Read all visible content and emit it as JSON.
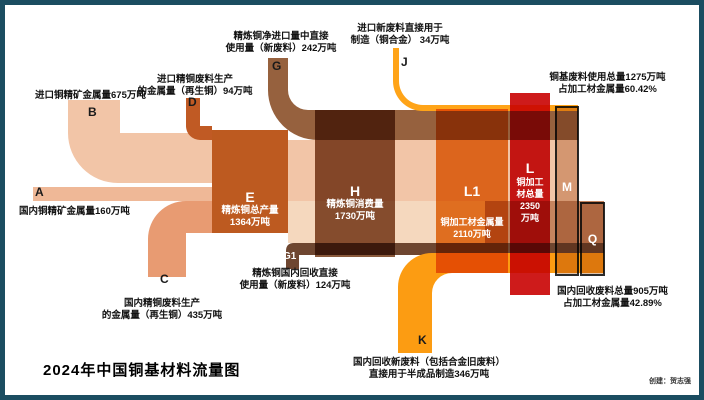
{
  "title": "2024年中国铜基材料流量图",
  "credit": "创建：贺志强",
  "unit": "万吨",
  "colors": {
    "frame": "#1B4D61",
    "peach": "#F2C5A7",
    "salmon": "#E89B72",
    "rust": "#C05A24",
    "e_node": "#BD5A20",
    "brown": "#96613E",
    "h_node": "#8A5A3C",
    "dark_brown": "#6E4630",
    "k_orange": "#FC9C12",
    "j_orange": "#FFA418",
    "l1_node": "#E8822B",
    "l_node": "#CE1B1B",
    "cream": "#F5D8BE",
    "tan": "#C5845E",
    "box_border": "#2A2A2A"
  },
  "flows": {
    "a": {
      "letter": "A",
      "label": "国内铜精矿金属量160万吨",
      "value": 160
    },
    "b": {
      "letter": "B",
      "label": "进口铜精矿金属量675万吨",
      "value": 675
    },
    "c": {
      "letter": "C",
      "label_line1": "国内精铜废料生产",
      "label_line2": "的金属量（再生铜）435万吨",
      "value": 435
    },
    "d": {
      "letter": "D",
      "label_line1": "进口精铜废料生产",
      "label_line2": "的金属量（再生铜）94万吨",
      "value": 94
    },
    "g": {
      "letter": "G",
      "label_line1": "精炼铜净进口量中直接",
      "label_line2": "使用量（新废料）242万吨",
      "value": 242
    },
    "g1": {
      "letter": "G1",
      "label_line1": "精炼铜国内回收直接",
      "label_line2": "使用量（新废料）124万吨",
      "value": 124
    },
    "j": {
      "letter": "J",
      "label_line1": "进口新废料直接用于",
      "label_line2": "制造（铜合金） 34万吨",
      "value": 34
    },
    "k": {
      "letter": "K",
      "label_line1": "国内回收新废料（包括合金旧废料）",
      "label_line2": "直接用于半成品制造346万吨",
      "value": 346
    }
  },
  "nodes": {
    "e": {
      "letter": "E",
      "name": "精炼铜总产量",
      "value_text": "1364万吨",
      "value": 1364
    },
    "h": {
      "letter": "H",
      "name": "精炼铜消费量",
      "value_text": "1730万吨",
      "value": 1730
    },
    "l1": {
      "letter": "L1",
      "name": "铜加工材金属量",
      "value_text": "2110万吨",
      "value": 2110
    },
    "l": {
      "letter": "L",
      "name_line1": "铜加工",
      "name_line2": "材总量",
      "value_line1": "2350",
      "value_line2": "万吨",
      "value": 2350
    },
    "m": {
      "letter": "M",
      "label_line1": "铜基废料使用总量1275万吨",
      "label_line2": "占加工材金属量60.42%",
      "value": 1275
    },
    "q": {
      "letter": "Q",
      "label_line1": "国内回收废料总量905万吨",
      "label_line2": "占加工材金属量42.89%",
      "value": 905
    }
  },
  "chart_data": {
    "type": "sankey",
    "title": "2024年中国铜基材料流量图",
    "unit": "万吨",
    "nodes": [
      {
        "id": "A",
        "label": "国内铜精矿金属量",
        "value": 160
      },
      {
        "id": "B",
        "label": "进口铜精矿金属量",
        "value": 675
      },
      {
        "id": "C",
        "label": "国内精铜废料生产的金属量（再生铜）",
        "value": 435
      },
      {
        "id": "D",
        "label": "进口精铜废料生产的金属量（再生铜）",
        "value": 94
      },
      {
        "id": "E",
        "label": "精炼铜总产量",
        "value": 1364
      },
      {
        "id": "G",
        "label": "精炼铜净进口量中直接使用量（新废料）",
        "value": 242
      },
      {
        "id": "G1",
        "label": "精炼铜国内回收直接使用量（新废料）",
        "value": 124
      },
      {
        "id": "H",
        "label": "精炼铜消费量",
        "value": 1730
      },
      {
        "id": "J",
        "label": "进口新废料直接用于制造（铜合金）",
        "value": 34
      },
      {
        "id": "K",
        "label": "国内回收新废料（包括合金旧废料）直接用于半成品制造",
        "value": 346
      },
      {
        "id": "L1",
        "label": "铜加工材金属量",
        "value": 2110
      },
      {
        "id": "L",
        "label": "铜加工材总量",
        "value": 2350
      }
    ],
    "links": [
      {
        "source": "A",
        "target": "E",
        "value": 160
      },
      {
        "source": "B",
        "target": "E",
        "value": 675
      },
      {
        "source": "C",
        "target": "E",
        "value": 435
      },
      {
        "source": "D",
        "target": "E",
        "value": 94
      },
      {
        "source": "E",
        "target": "H",
        "value": 1364
      },
      {
        "source": "G",
        "target": "H",
        "value": 242
      },
      {
        "source": "G1",
        "target": "H",
        "value": 124
      },
      {
        "source": "H",
        "target": "L1",
        "value": 1730
      },
      {
        "source": "J",
        "target": "L1",
        "value": 34
      },
      {
        "source": "K",
        "target": "L1",
        "value": 346
      },
      {
        "source": "L1",
        "target": "L",
        "value": 2110
      }
    ],
    "summary_boxes": [
      {
        "id": "M",
        "label": "铜基废料使用总量",
        "value": 1275,
        "share_text": "占加工材金属量60.42%",
        "includes": [
          "C",
          "D",
          "G",
          "G1",
          "J",
          "K"
        ]
      },
      {
        "id": "Q",
        "label": "国内回收废料总量",
        "value": 905,
        "share_text": "占加工材金属量42.89%",
        "includes": [
          "C",
          "G1",
          "K"
        ]
      }
    ]
  }
}
